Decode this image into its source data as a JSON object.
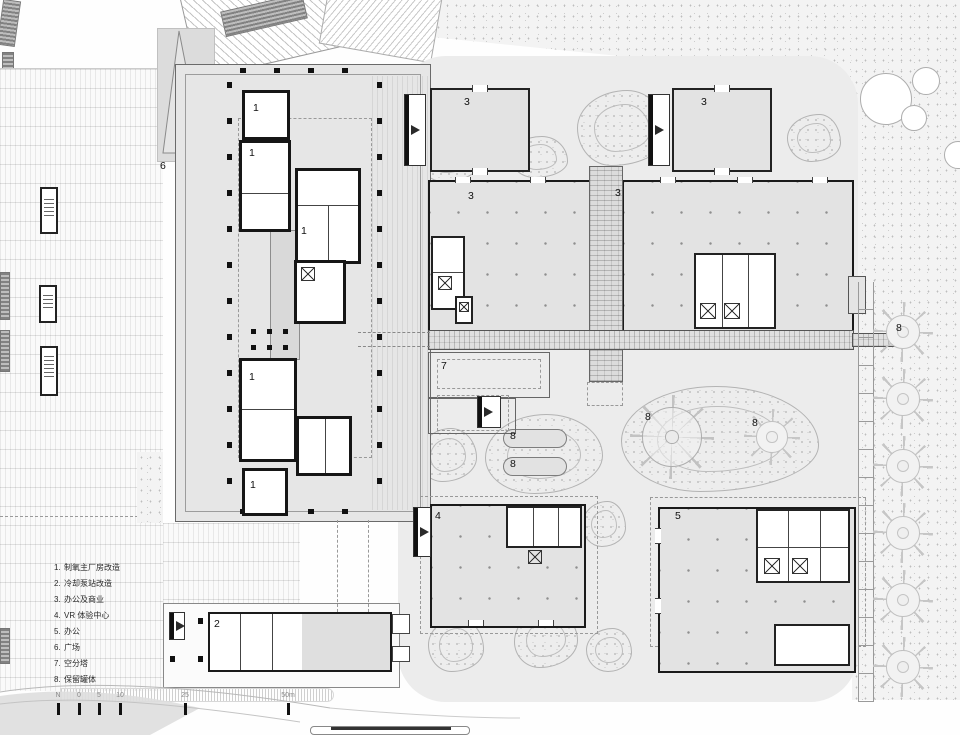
{
  "legend": {
    "items": [
      {
        "num": "1.",
        "label": "制氧主厂房改造"
      },
      {
        "num": "2.",
        "label": "冷却泵站改造"
      },
      {
        "num": "3.",
        "label": "办公及商业"
      },
      {
        "num": "4.",
        "label": "VR 体验中心"
      },
      {
        "num": "5.",
        "label": "办公"
      },
      {
        "num": "6.",
        "label": "广场"
      },
      {
        "num": "7.",
        "label": "空分塔"
      },
      {
        "num": "8.",
        "label": "保留罐体"
      }
    ]
  },
  "scalebar": {
    "labels": [
      "N",
      "0",
      "5",
      "10",
      "25",
      "50m"
    ]
  },
  "markers": [
    {
      "name": "main-plant-room",
      "text": "1"
    },
    {
      "name": "main-plant-room",
      "text": "1"
    },
    {
      "name": "main-plant-room",
      "text": "1"
    },
    {
      "name": "main-plant-room",
      "text": "1"
    },
    {
      "name": "main-plant-room",
      "text": "1"
    },
    {
      "name": "pump-station",
      "text": "2"
    },
    {
      "name": "office-commerce-small-left",
      "text": "3"
    },
    {
      "name": "office-commerce-small-right",
      "text": "3"
    },
    {
      "name": "office-commerce-hall-left",
      "text": "3"
    },
    {
      "name": "office-commerce-hall-right",
      "text": "3"
    },
    {
      "name": "vr-center",
      "text": "4"
    },
    {
      "name": "office-building",
      "text": "5"
    },
    {
      "name": "plaza",
      "text": "6"
    },
    {
      "name": "air-separation-tower",
      "text": "7"
    },
    {
      "name": "retained-tank-pill-top",
      "text": "8"
    },
    {
      "name": "retained-tank-pill-bottom",
      "text": "8"
    },
    {
      "name": "retained-tank-round-large",
      "text": "8"
    },
    {
      "name": "retained-tank-round-small",
      "text": "8"
    },
    {
      "name": "retained-tank-column",
      "text": "8"
    }
  ],
  "colors": {
    "wall": "#1a1a1a",
    "site_pad": "#ececec",
    "building_fill": "#e3e3e3"
  }
}
